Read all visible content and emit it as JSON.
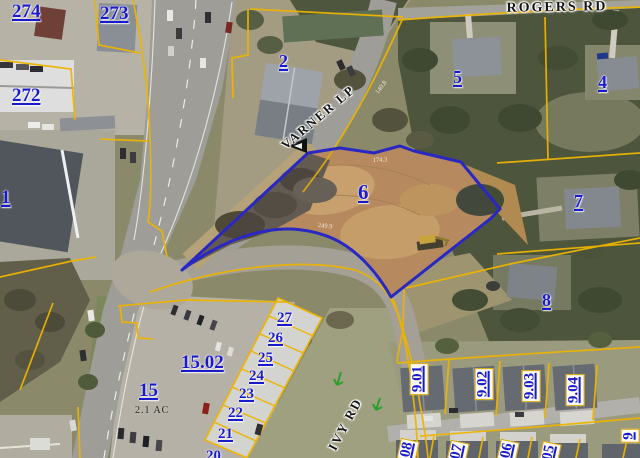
{
  "map": {
    "title": "parcel-aerial-map",
    "highlighted_parcel": "6",
    "colors": {
      "parcel_label_blue": "#1a1acd",
      "parcel_line_yellow": "#edb400",
      "highlight_outline_blue": "#2a28c2",
      "road_label_black": "#151515",
      "dirt_lot_tan": "#c09058"
    },
    "roads": [
      {
        "name": "ROGERS RD"
      },
      {
        "name": "VARNER LP"
      },
      {
        "name": "IVY RD"
      }
    ],
    "parcels": [
      {
        "label": "274"
      },
      {
        "label": "273"
      },
      {
        "label": "272"
      },
      {
        "label": "1"
      },
      {
        "label": "2"
      },
      {
        "label": "5"
      },
      {
        "label": "4"
      },
      {
        "label": "6"
      },
      {
        "label": "7"
      },
      {
        "label": "8"
      },
      {
        "label": "15.02"
      },
      {
        "label": "15"
      },
      {
        "label": "27"
      },
      {
        "label": "26"
      },
      {
        "label": "25"
      },
      {
        "label": "24"
      },
      {
        "label": "23"
      },
      {
        "label": "22"
      },
      {
        "label": "21"
      },
      {
        "label": "20"
      },
      {
        "label": "9.01"
      },
      {
        "label": "9.02"
      },
      {
        "label": "9.03"
      },
      {
        "label": "9.04"
      },
      {
        "label": "08"
      },
      {
        "label": "07"
      },
      {
        "label": "06"
      },
      {
        "label": "05"
      },
      {
        "label": "9"
      }
    ],
    "annotations": {
      "acreage": "2.1 AC"
    },
    "dimensions": [
      "174.3",
      "249.9",
      "140.8"
    ]
  }
}
